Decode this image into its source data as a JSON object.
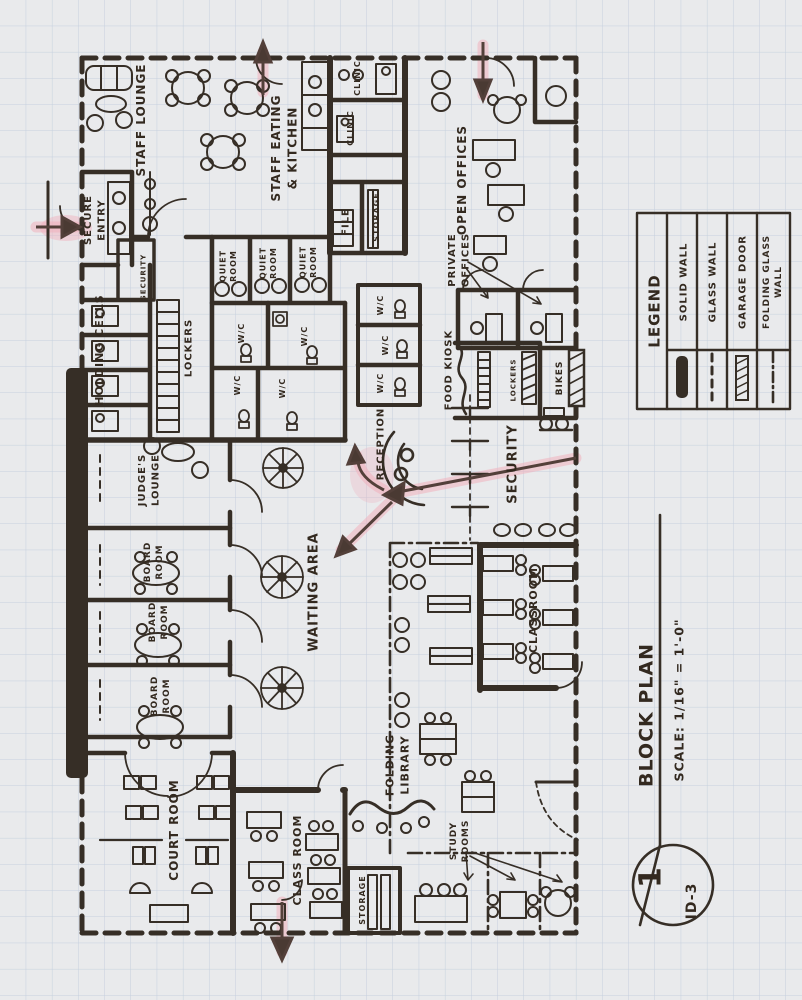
{
  "colors": {
    "ink": "#362e26",
    "paper": "#e9eaec",
    "grid": "#b9c7d9",
    "highlight": "#f0b0bd",
    "arrow": "#53403a"
  },
  "title_block": {
    "sheet_number": "1",
    "sheet_id": "ID-3",
    "drawing_title": "BLOCK PLAN",
    "scale": "SCALE: 1/16\" = 1'-0\""
  },
  "legend": {
    "heading": "LEGEND",
    "items": [
      {
        "id": "solid-wall",
        "lines": [
          "SOLID WALL"
        ]
      },
      {
        "id": "glass-wall",
        "lines": [
          "GLASS WALL"
        ]
      },
      {
        "id": "garage-door",
        "lines": [
          "GARAGE DOOR"
        ]
      },
      {
        "id": "folding-glass-wall",
        "lines": [
          "FOLDING GLASS",
          "WALL"
        ]
      }
    ]
  },
  "room_labels": [
    {
      "id": "staff-lounge",
      "lines": [
        "STAFF LOUNGE"
      ],
      "x": 141,
      "y": 120,
      "size": 12
    },
    {
      "id": "secure-entry",
      "lines": [
        "SECURE",
        "ENTRY"
      ],
      "x": 94,
      "y": 220,
      "size": 10
    },
    {
      "id": "staff-eating-kitchen",
      "lines": [
        "STAFF EATING",
        "& KITCHEN"
      ],
      "x": 284,
      "y": 148,
      "size": 12
    },
    {
      "id": "clinic-1",
      "lines": [
        "CLINIC"
      ],
      "x": 357,
      "y": 78,
      "size": 8
    },
    {
      "id": "clinic-2",
      "lines": [
        "CLINIC"
      ],
      "x": 350,
      "y": 128,
      "size": 8
    },
    {
      "id": "file-room",
      "lines": [
        "FILE"
      ],
      "x": 345,
      "y": 222,
      "size": 10
    },
    {
      "id": "storage-file",
      "lines": [
        "STORAGE"
      ],
      "x": 376,
      "y": 217,
      "size": 8
    },
    {
      "id": "open-offices",
      "lines": [
        "OPEN OFFICES"
      ],
      "x": 462,
      "y": 180,
      "size": 12
    },
    {
      "id": "private-offices",
      "lines": [
        "PRIVATE",
        "OFFICES"
      ],
      "x": 458,
      "y": 260,
      "size": 10
    },
    {
      "id": "quiet-room-1",
      "lines": [
        "QUIET",
        "ROOM"
      ],
      "x": 228,
      "y": 266,
      "size": 8
    },
    {
      "id": "quiet-room-2",
      "lines": [
        "QUIET",
        "ROOM"
      ],
      "x": 268,
      "y": 263,
      "size": 8
    },
    {
      "id": "quiet-room-3",
      "lines": [
        "QUIET",
        "ROOM"
      ],
      "x": 308,
      "y": 262,
      "size": 8
    },
    {
      "id": "security-holding",
      "lines": [
        "SECURITY"
      ],
      "x": 143,
      "y": 277,
      "size": 7
    },
    {
      "id": "holding-cells",
      "lines": [
        "HOLDING CELLS"
      ],
      "x": 99,
      "y": 350,
      "size": 11
    },
    {
      "id": "lockers",
      "lines": [
        "LOCKERS"
      ],
      "x": 188,
      "y": 348,
      "size": 10
    },
    {
      "id": "wc-1",
      "lines": [
        "W/C"
      ],
      "x": 241,
      "y": 333,
      "size": 8
    },
    {
      "id": "wc-2",
      "lines": [
        "W/C"
      ],
      "x": 304,
      "y": 336,
      "size": 8
    },
    {
      "id": "wc-3",
      "lines": [
        "W/C"
      ],
      "x": 237,
      "y": 385,
      "size": 8
    },
    {
      "id": "wc-4",
      "lines": [
        "W/C"
      ],
      "x": 282,
      "y": 388,
      "size": 8
    },
    {
      "id": "wc-5",
      "lines": [
        "W/C"
      ],
      "x": 380,
      "y": 305,
      "size": 8
    },
    {
      "id": "wc-6",
      "lines": [
        "W/C"
      ],
      "x": 385,
      "y": 345,
      "size": 8
    },
    {
      "id": "wc-7",
      "lines": [
        "W/C"
      ],
      "x": 380,
      "y": 383,
      "size": 8
    },
    {
      "id": "reception",
      "lines": [
        "RECEPTION"
      ],
      "x": 380,
      "y": 444,
      "size": 10
    },
    {
      "id": "food-kiosk",
      "lines": [
        "FOOD KIOSK"
      ],
      "x": 448,
      "y": 370,
      "size": 10
    },
    {
      "id": "lockers-bikes",
      "lines": [
        "LOCKERS"
      ],
      "x": 513,
      "y": 380,
      "size": 7
    },
    {
      "id": "bikes",
      "lines": [
        "BIKES"
      ],
      "x": 559,
      "y": 378,
      "size": 9
    },
    {
      "id": "security-main",
      "lines": [
        "SECURITY"
      ],
      "x": 512,
      "y": 464,
      "size": 13
    },
    {
      "id": "judges-lounge",
      "lines": [
        "JUDGE'S",
        "LOUNGE"
      ],
      "x": 148,
      "y": 480,
      "size": 10
    },
    {
      "id": "board-room-1",
      "lines": [
        "BOARD",
        "ROOM"
      ],
      "x": 153,
      "y": 562,
      "size": 9
    },
    {
      "id": "board-room-2",
      "lines": [
        "BOARD",
        "ROOM"
      ],
      "x": 158,
      "y": 622,
      "size": 9
    },
    {
      "id": "board-room-3",
      "lines": [
        "BOARD",
        "ROOM"
      ],
      "x": 160,
      "y": 696,
      "size": 9
    },
    {
      "id": "waiting-area",
      "lines": [
        "WAITING AREA"
      ],
      "x": 313,
      "y": 592,
      "size": 13
    },
    {
      "id": "court-room",
      "lines": [
        "COURT ROOM"
      ],
      "x": 174,
      "y": 830,
      "size": 12
    },
    {
      "id": "classroom-left",
      "lines": [
        "CLASS ROOM"
      ],
      "x": 297,
      "y": 860,
      "size": 11
    },
    {
      "id": "storage-small",
      "lines": [
        "STORAGE"
      ],
      "x": 362,
      "y": 900,
      "size": 8
    },
    {
      "id": "folding-library",
      "lines": [
        "FOLDING",
        "LIBRARY"
      ],
      "x": 397,
      "y": 765,
      "size": 11
    },
    {
      "id": "study-rooms",
      "lines": [
        "STUDY",
        "ROOMS"
      ],
      "x": 459,
      "y": 841,
      "size": 9
    },
    {
      "id": "classroom-right",
      "lines": [
        "CLASSROOM"
      ],
      "x": 533,
      "y": 610,
      "size": 11
    }
  ]
}
